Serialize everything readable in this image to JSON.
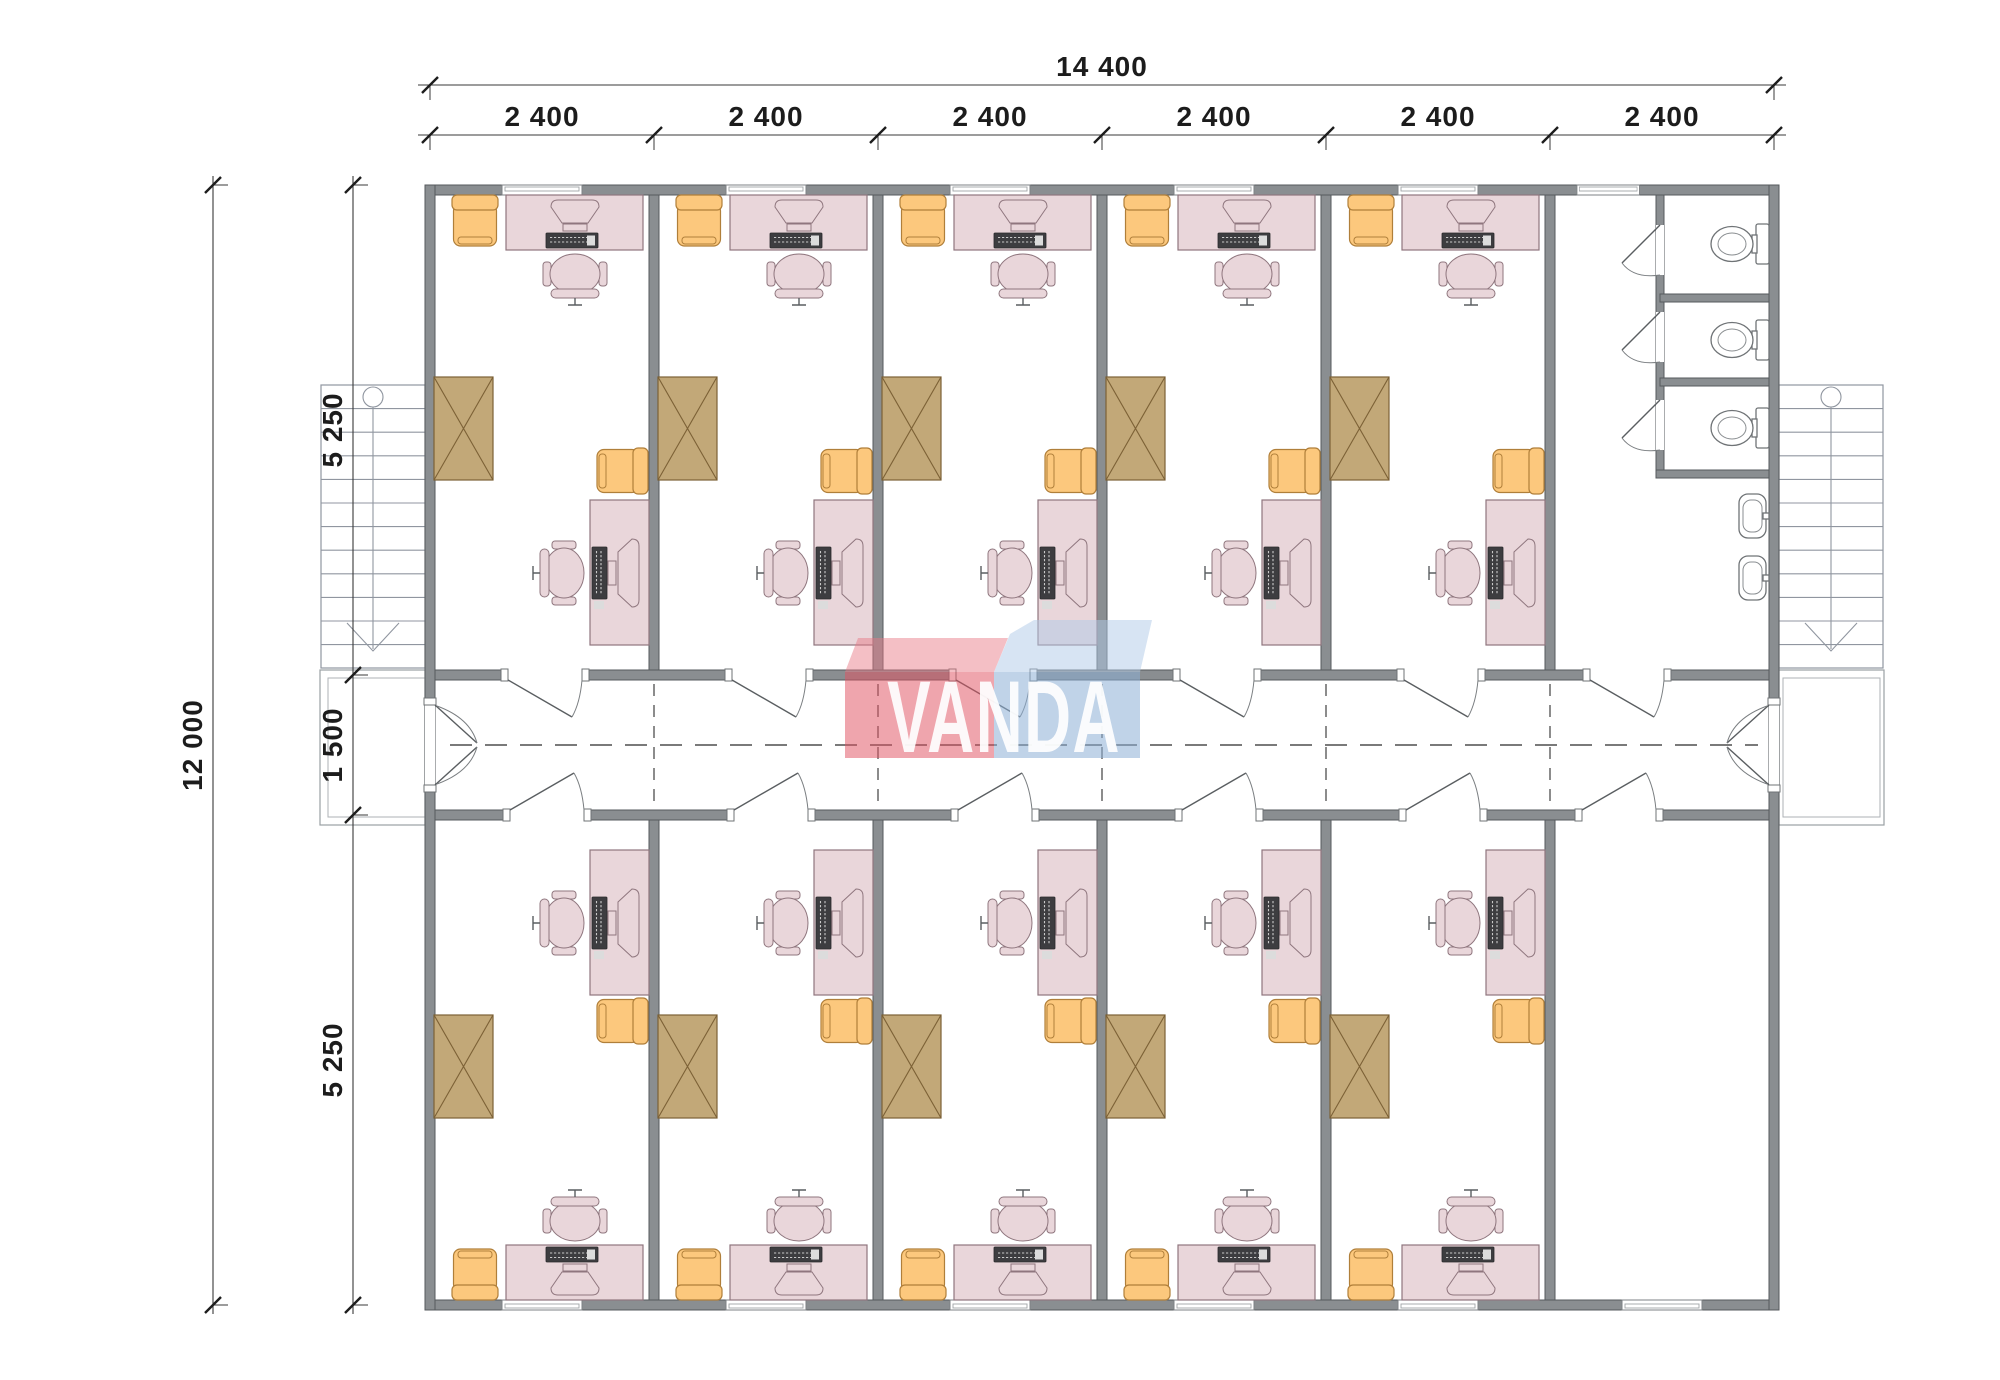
{
  "dimensions": {
    "horizontal_total": "14 400",
    "horizontal_bays": [
      "2 400",
      "2 400",
      "2 400",
      "2 400",
      "2 400",
      "2 400"
    ],
    "vertical_total": "12 000",
    "vertical_segments": [
      "5 250",
      "1 500",
      "5 250"
    ]
  },
  "watermark": {
    "text": "VANDA"
  },
  "colors": {
    "wall": "#8a8e91",
    "desk": "#e9d6da",
    "keyboard": "#3d3d40",
    "armchair": "#fcc87d",
    "cabinet": "#c2a878",
    "dimension_text": "#1c1c1c",
    "logo_red": "rgba(224,83,97,0.52)",
    "logo_blue": "rgba(140,175,214,0.55)"
  },
  "plan": {
    "office_rooms": 10,
    "toilet_stalls": 3,
    "wash_basins": 2,
    "staircases": 2,
    "corridors": 1
  }
}
